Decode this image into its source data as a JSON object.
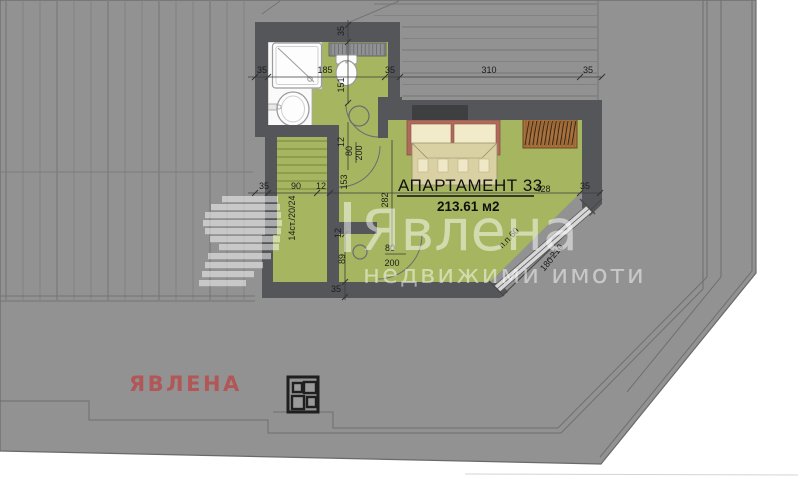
{
  "watermark": {
    "brand": "Явлена",
    "tagline": "недвижими имоти",
    "corner_text": "ЯВЛЕНА"
  },
  "plan": {
    "title": "АПАРТАМЕНТ 33",
    "area": "213.61 м2",
    "dim_labels": [
      {
        "text": "35",
        "x": 262,
        "y": 73
      },
      {
        "text": "185",
        "x": 325,
        "y": 73
      },
      {
        "text": "35",
        "x": 390,
        "y": 73
      },
      {
        "text": "310",
        "x": 489,
        "y": 73
      },
      {
        "text": "35",
        "x": 588,
        "y": 73
      },
      {
        "text": "35",
        "x": 344,
        "y": 31,
        "rot": -90
      },
      {
        "text": "151",
        "x": 344,
        "y": 85,
        "rot": -90
      },
      {
        "text": "12",
        "x": 344,
        "y": 142,
        "rot": -90
      },
      {
        "text": "80",
        "x": 352,
        "y": 151,
        "rot": -90
      },
      {
        "text": "200",
        "x": 362,
        "y": 153,
        "rot": -90
      },
      {
        "text": "35",
        "x": 264,
        "y": 189
      },
      {
        "text": "90",
        "x": 296,
        "y": 189
      },
      {
        "text": "12",
        "x": 321,
        "y": 189
      },
      {
        "text": "153",
        "x": 347,
        "y": 182,
        "rot": -90
      },
      {
        "text": "282",
        "x": 388,
        "y": 200,
        "rot": -90
      },
      {
        "text": "428",
        "x": 543,
        "y": 192
      },
      {
        "text": "35",
        "x": 585,
        "y": 189
      },
      {
        "text": "14ст./20/24",
        "x": 295,
        "y": 218,
        "rot": -90
      },
      {
        "text": "12",
        "x": 341,
        "y": 233,
        "rot": -90
      },
      {
        "text": "89",
        "x": 345,
        "y": 259,
        "rot": -90
      },
      {
        "text": "35",
        "x": 336,
        "y": 292
      },
      {
        "text": "80",
        "x": 390,
        "y": 251
      },
      {
        "text": "200",
        "x": 392,
        "y": 266
      },
      {
        "text": "210",
        "x": 559,
        "y": 253,
        "rot": -50
      },
      {
        "text": "180",
        "x": 549,
        "y": 266,
        "rot": -50
      },
      {
        "text": "п.п.60",
        "x": 511,
        "y": 240,
        "rot": -46
      }
    ]
  },
  "colors": {
    "terrace_gray": "#929292",
    "wall_dark": "#55565a",
    "floor_green": "#a6b55f",
    "wood_deck": "#a9713c",
    "skylight_frame": "#b06a5c",
    "skylight_cream": "#f1ebc9",
    "skylight_tan": "#d9d0a3",
    "brand_red": "#b25757"
  }
}
